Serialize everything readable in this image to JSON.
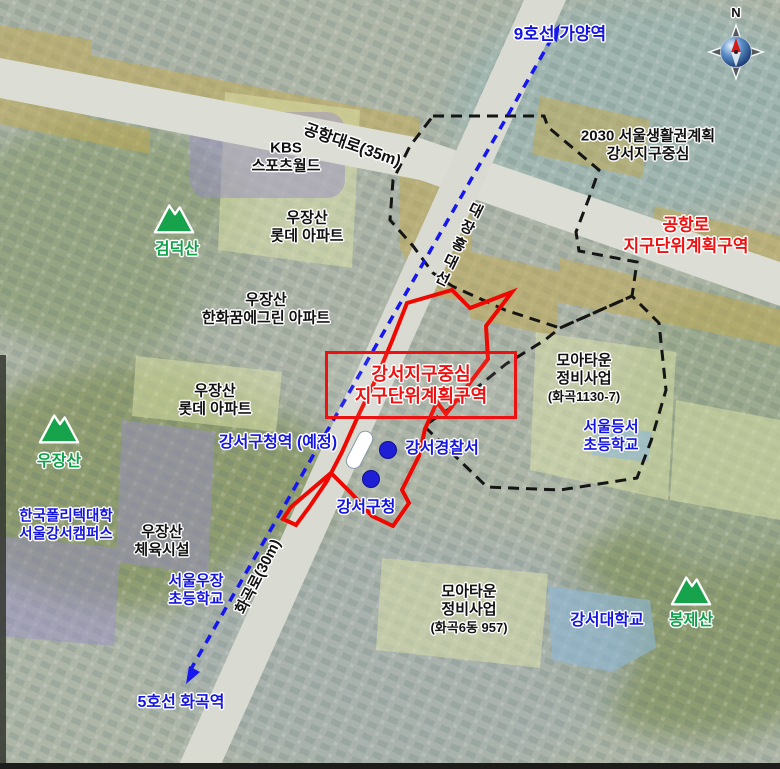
{
  "compass": {
    "north_label": "N"
  },
  "subway": {
    "line9_station": "9호선 가양역",
    "line5_station": "5호선 화곡역",
    "planned_station": "강서구청역 (예정)",
    "rail_line": "대장홍대선"
  },
  "roads": {
    "gonghang_daero": "공항대로(35m)",
    "hwagok_ro": "화곡로(30m)"
  },
  "zones": {
    "district_center": {
      "line1": "강서지구중심",
      "line2": "지구단위계획구역"
    },
    "gonghangno": {
      "line1": "공항로",
      "line2": "지구단위계획구역"
    },
    "plan2030": {
      "line1": "2030 서울생활권계획",
      "line2": "강서지구중심"
    },
    "moatown_hwagok1130": {
      "line1": "모아타운",
      "line2": "정비사업",
      "line3": "(화곡1130-7)"
    },
    "moatown_hwagok6": {
      "line1": "모아타운",
      "line2": "정비사업",
      "line3": "(화곡6동 957)"
    }
  },
  "places": {
    "kbs": {
      "line1": "KBS",
      "line2": "스포츠월드"
    },
    "lotte_apt_north": {
      "line1": "우장산",
      "line2": "롯데 아파트"
    },
    "hanwha_apt": {
      "line1": "우장산",
      "line2": "한화꿈에그린 아파트"
    },
    "lotte_apt_west": {
      "line1": "우장산",
      "line2": "롯데 아파트"
    },
    "police": "강서경찰서",
    "gu_office": "강서구청",
    "deungseo_elementary": {
      "line1": "서울등서",
      "line2": "초등학교"
    },
    "ujang_elementary": {
      "line1": "서울우장",
      "line2": "초등학교"
    },
    "polytech": {
      "line1": "한국폴리텍대학",
      "line2": "서울강서캠퍼스"
    },
    "sports_facility": {
      "line1": "우장산",
      "line2": "체육시설"
    },
    "gangseo_university": "강서대학교"
  },
  "mountains": {
    "geomdeoksan": "검덕산",
    "ujangsan": "우장산",
    "bongjesan": "봉제산"
  },
  "colors": {
    "station_blue": "#1414e0",
    "mountain_green": "#12a14b",
    "zone_red": "#ee1111",
    "boundary_black": "#151515",
    "rail_blue": "#1616f0",
    "road_overlay_yellow": "#c3a94e"
  }
}
